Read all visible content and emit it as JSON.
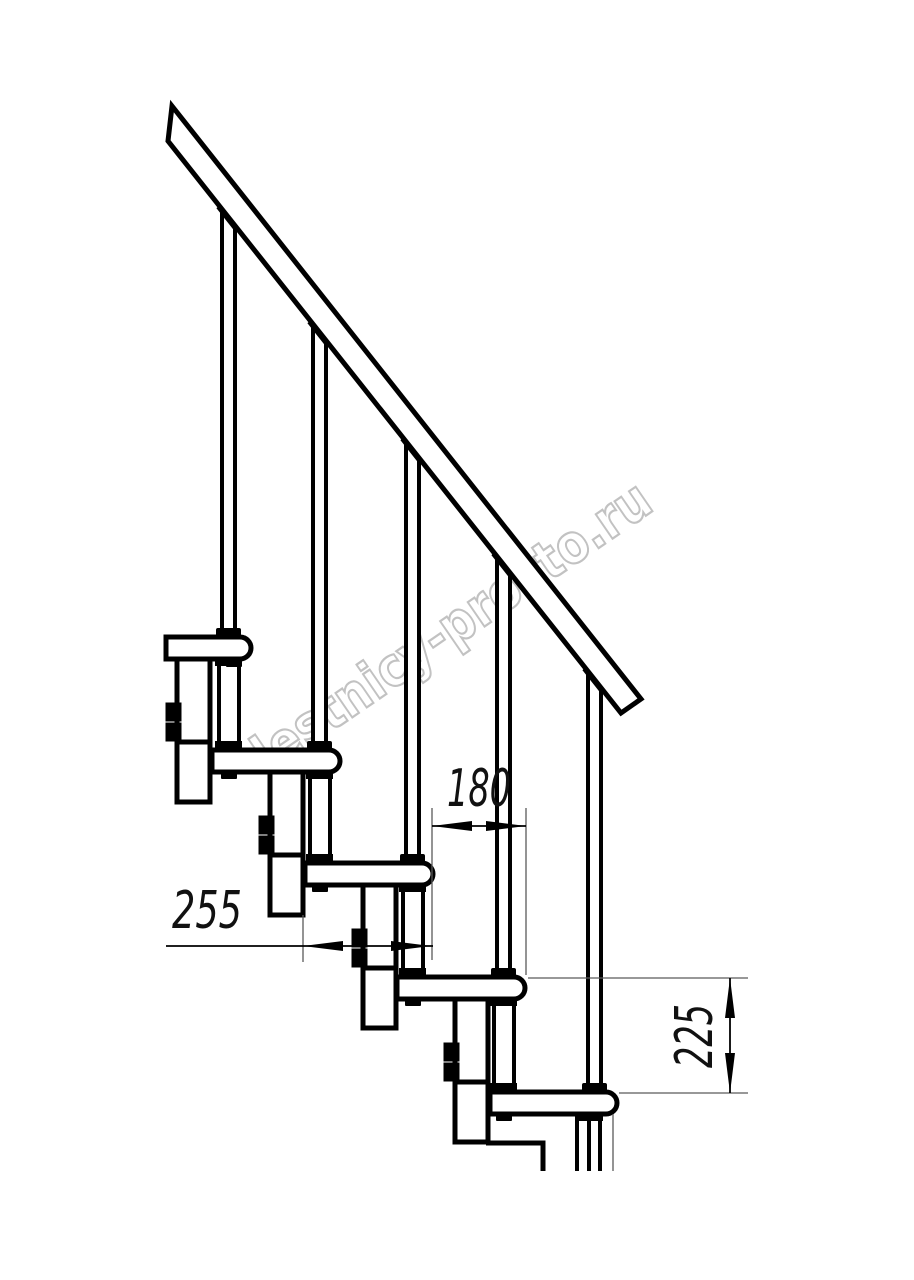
{
  "figure": {
    "type": "technical-line-drawing",
    "subject": "Modular staircase side elevation: handrail, balusters, treads, support columns",
    "background_color": "#ffffff",
    "line_color": "#000000",
    "thin_line_color": "#5a5a5a",
    "treads_visible": 5,
    "balusters_visible": 5
  },
  "watermark": {
    "text": "lestnicy-prosto.ru",
    "outline_color": "#c2c2c2",
    "fill_color": "#ffffff",
    "angle_deg": -34.5
  },
  "dimensions": {
    "step_depth": {
      "label": "180",
      "orientation": "horizontal"
    },
    "step_run": {
      "label": "255",
      "orientation": "horizontal"
    },
    "step_rise": {
      "label": "225",
      "orientation": "vertical"
    }
  }
}
